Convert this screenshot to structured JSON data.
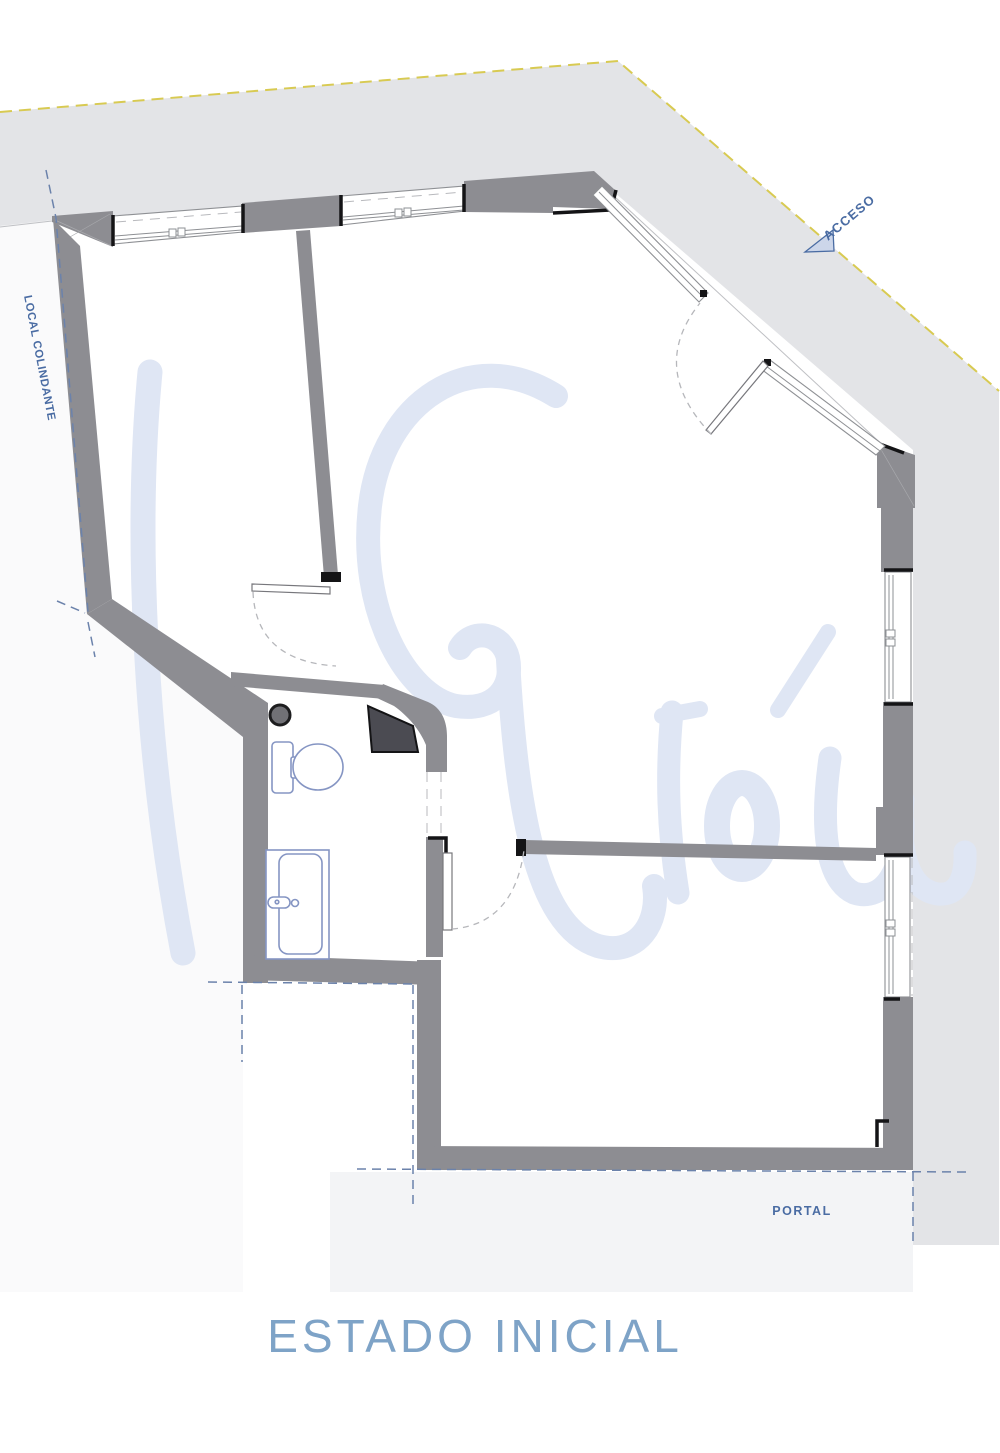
{
  "title": {
    "text": "ESTADO INICIAL"
  },
  "labels": {
    "access": "ACCESO",
    "adjacent_premises": "LOCAL COLINDANTE",
    "portal": "PORTAL"
  },
  "plan": {
    "type": "architectural-floor-plan",
    "rooms": [
      "left-room",
      "main-room",
      "bathroom",
      "lower-room"
    ],
    "fixtures": [
      "toilet",
      "sink",
      "column"
    ],
    "openings": [
      "top-window-1",
      "top-window-2",
      "right-window-upper",
      "right-window-lower",
      "entrance-glazing-1",
      "entrance-glazing-2",
      "entrance-door",
      "left-room-door",
      "lower-room-door"
    ]
  },
  "colors": {
    "wall": "#8d8d92",
    "wallDark": "#4b4b52",
    "ink": "#141416",
    "sidewalk": "#e3e4e7",
    "portal": "#f3f4f6",
    "adjacent": "#fafafb",
    "yellow": "#d8ca52",
    "refBlue": "#6b82ab",
    "frame": "#8e9094",
    "arc": "#b6b7bb",
    "fixture": "#8595c3",
    "watermark": "#dfe6f4",
    "label": "#4a6ca3",
    "title": "#7ea3c7"
  }
}
